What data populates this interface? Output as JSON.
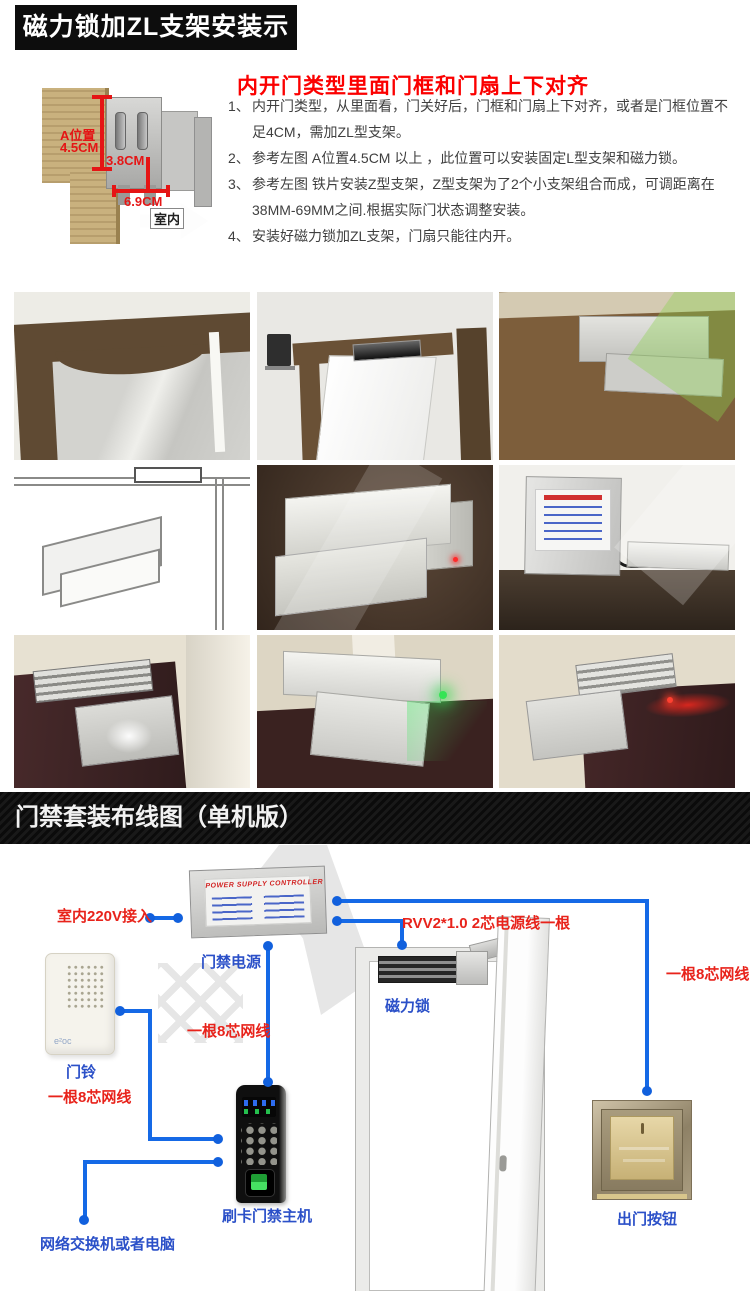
{
  "section1": {
    "title": "磁力锁加ZL支架安装示意图",
    "heading": "内开门类型里面门框和门扇上下对齐",
    "diagram": {
      "dim_a_line1": "A位置",
      "dim_a_line2": "4.5CM",
      "dim_b": "3.8CM",
      "dim_c": "6.9CM",
      "arrow_label": "室内"
    },
    "instructions": [
      {
        "num": "1、",
        "text": "内开门类型，从里面看，门关好后，门框和门扇上下对齐，或者是门框位置不足4CM，需加ZL型支架。"
      },
      {
        "num": "2、",
        "text": "参考左图 A位置4.5CM 以上 ，此位置可以安装固定L型支架和磁力锁。"
      },
      {
        "num": "3、",
        "text": "参考左图 铁片安装Z型支架，Z型支架为了2个小支架组合而成，可调距离在38MM-69MM之间.根据实际门状态调整安装。"
      },
      {
        "num": "4、",
        "text": "安装好磁力锁加ZL支架，门扇只能往内开。"
      }
    ]
  },
  "gallery": {
    "photos": [
      {
        "name": "wood-door-frame-arch-corner"
      },
      {
        "name": "open-door-with-maglock-on-frame"
      },
      {
        "name": "zl-bracket-on-wood-door"
      },
      {
        "name": "zl-bracket-cad-drawing"
      },
      {
        "name": "zl-bracket-kit-closeup"
      },
      {
        "name": "power-supply-with-maglock"
      },
      {
        "name": "maglock-bracket-installed-dark-door"
      },
      {
        "name": "maglock-installed-green-led"
      },
      {
        "name": "maglock-installed-red-led"
      }
    ]
  },
  "section2": {
    "banner": "门禁套装布线图（单机版）",
    "labels": {
      "mains": "室内220V接入",
      "psu_name": "门禁电源",
      "net8_mid": "一根8芯网线",
      "doorbell": "门铃",
      "net8_left": "一根8芯网线",
      "power_cable": "RVV2*1.0 2芯电源线一根",
      "maglock": "磁力锁",
      "net8_right": "一根8芯网线",
      "reader": "刷卡门禁主机",
      "network": "网络交换机或者电脑",
      "exit_button": "出门按钮"
    },
    "devices": {
      "psu_title": "POWER SUPPLY CONTROLLER",
      "doorbell_logo": "e²oc"
    },
    "colors": {
      "wire_blue": "#1569e6",
      "label_red": "#e8231b",
      "label_blue": "#2b50c8"
    }
  }
}
